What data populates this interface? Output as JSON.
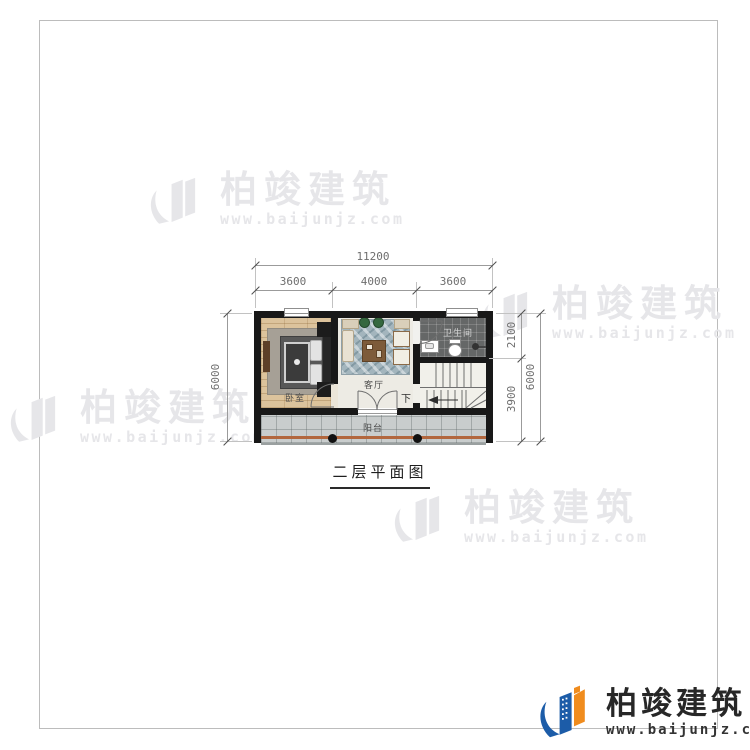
{
  "title": {
    "text": "二层平面图"
  },
  "brand": {
    "name": "柏竣建筑",
    "url": "www.baijunjz.com",
    "blue": "#1c5ca8",
    "orange": "#f08c1e",
    "text_dark": "#272727"
  },
  "watermark": {
    "name": "柏竣建筑",
    "url": "www.baijunjz.com",
    "color": "#e6e6e9"
  },
  "dimensions": {
    "top_total": "11200",
    "top_segments": [
      "3600",
      "4000",
      "3600"
    ],
    "left_total": "6000",
    "right_segments": [
      "2100",
      "3900"
    ],
    "right_total": "6000"
  },
  "rooms": {
    "bedroom": "卧室",
    "living": "客厅",
    "bathroom": "卫生间",
    "balcony": "阳台",
    "stairs_down": "下"
  },
  "colors": {
    "wall": "#181818",
    "wood_floor": "#dcc39c",
    "living_floor": "#edebe4",
    "bath_floor": "#656767",
    "stair_floor": "#f1f0ea",
    "balcony_floor": "#c9cdcd",
    "railing": "#b2673e",
    "dimension_line": "#9b9b9b"
  }
}
